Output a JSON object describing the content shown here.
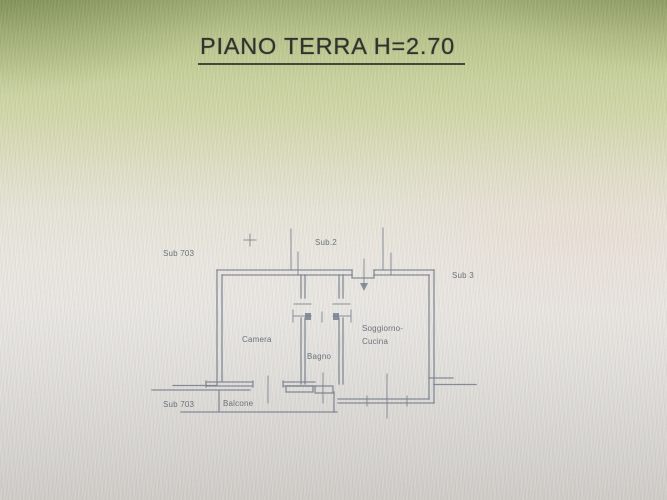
{
  "title": {
    "text": "PIANO TERRA H=2.70"
  },
  "plan": {
    "labels": {
      "sub703_top": "Sub 703",
      "sub2": "Sub.2",
      "sub3": "Sub 3",
      "camera": "Camera",
      "bagno": "Bagno",
      "soggiorno_line1": "Soggiorno-",
      "soggiorno_line2": "Cucina",
      "sub703_bottom": "Sub 703",
      "balcone": "Balcone"
    },
    "colors": {
      "line": "#78808e",
      "label": "#5f6670",
      "title": "#30332d"
    }
  }
}
